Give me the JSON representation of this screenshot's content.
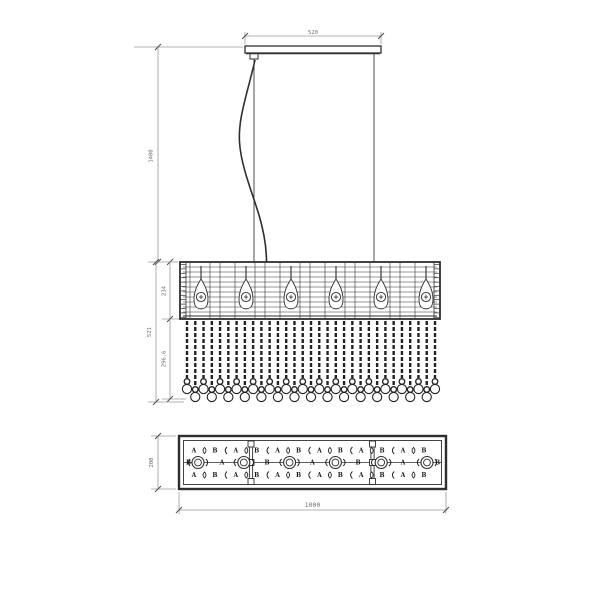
{
  "drawing_title": "linear crystal chandelier technical drawing",
  "colors": {
    "ink": "#2e2e2e",
    "dim_line": "#9a9a9a",
    "tick": "#4d4d4d",
    "dim_text": "#6f6f6f",
    "letter": "#1c1c1c",
    "background": "#ffffff"
  },
  "front_view": {
    "canopy": {
      "width_label": "520"
    },
    "suspension": {
      "height_label": "1400"
    },
    "shade": {
      "height_label": "234",
      "bulb_count": 6
    },
    "crystals": {
      "strand_count": 31,
      "drop_label": "296.6",
      "total_label": "521"
    }
  },
  "plan_view": {
    "depth_label": "200",
    "width_label": "1000",
    "socket_count": 6,
    "section_count": 3,
    "rows": {
      "top": [
        "A",
        "B",
        "A",
        "B",
        "A",
        "B",
        "A",
        "B",
        "A",
        "B",
        "A",
        "B"
      ],
      "middle": [
        "B",
        "A",
        "B",
        "A",
        "B",
        "A",
        "B"
      ],
      "bottom": [
        "A",
        "B",
        "A",
        "B",
        "A",
        "B",
        "A",
        "B",
        "A",
        "B",
        "A",
        "B"
      ]
    }
  }
}
